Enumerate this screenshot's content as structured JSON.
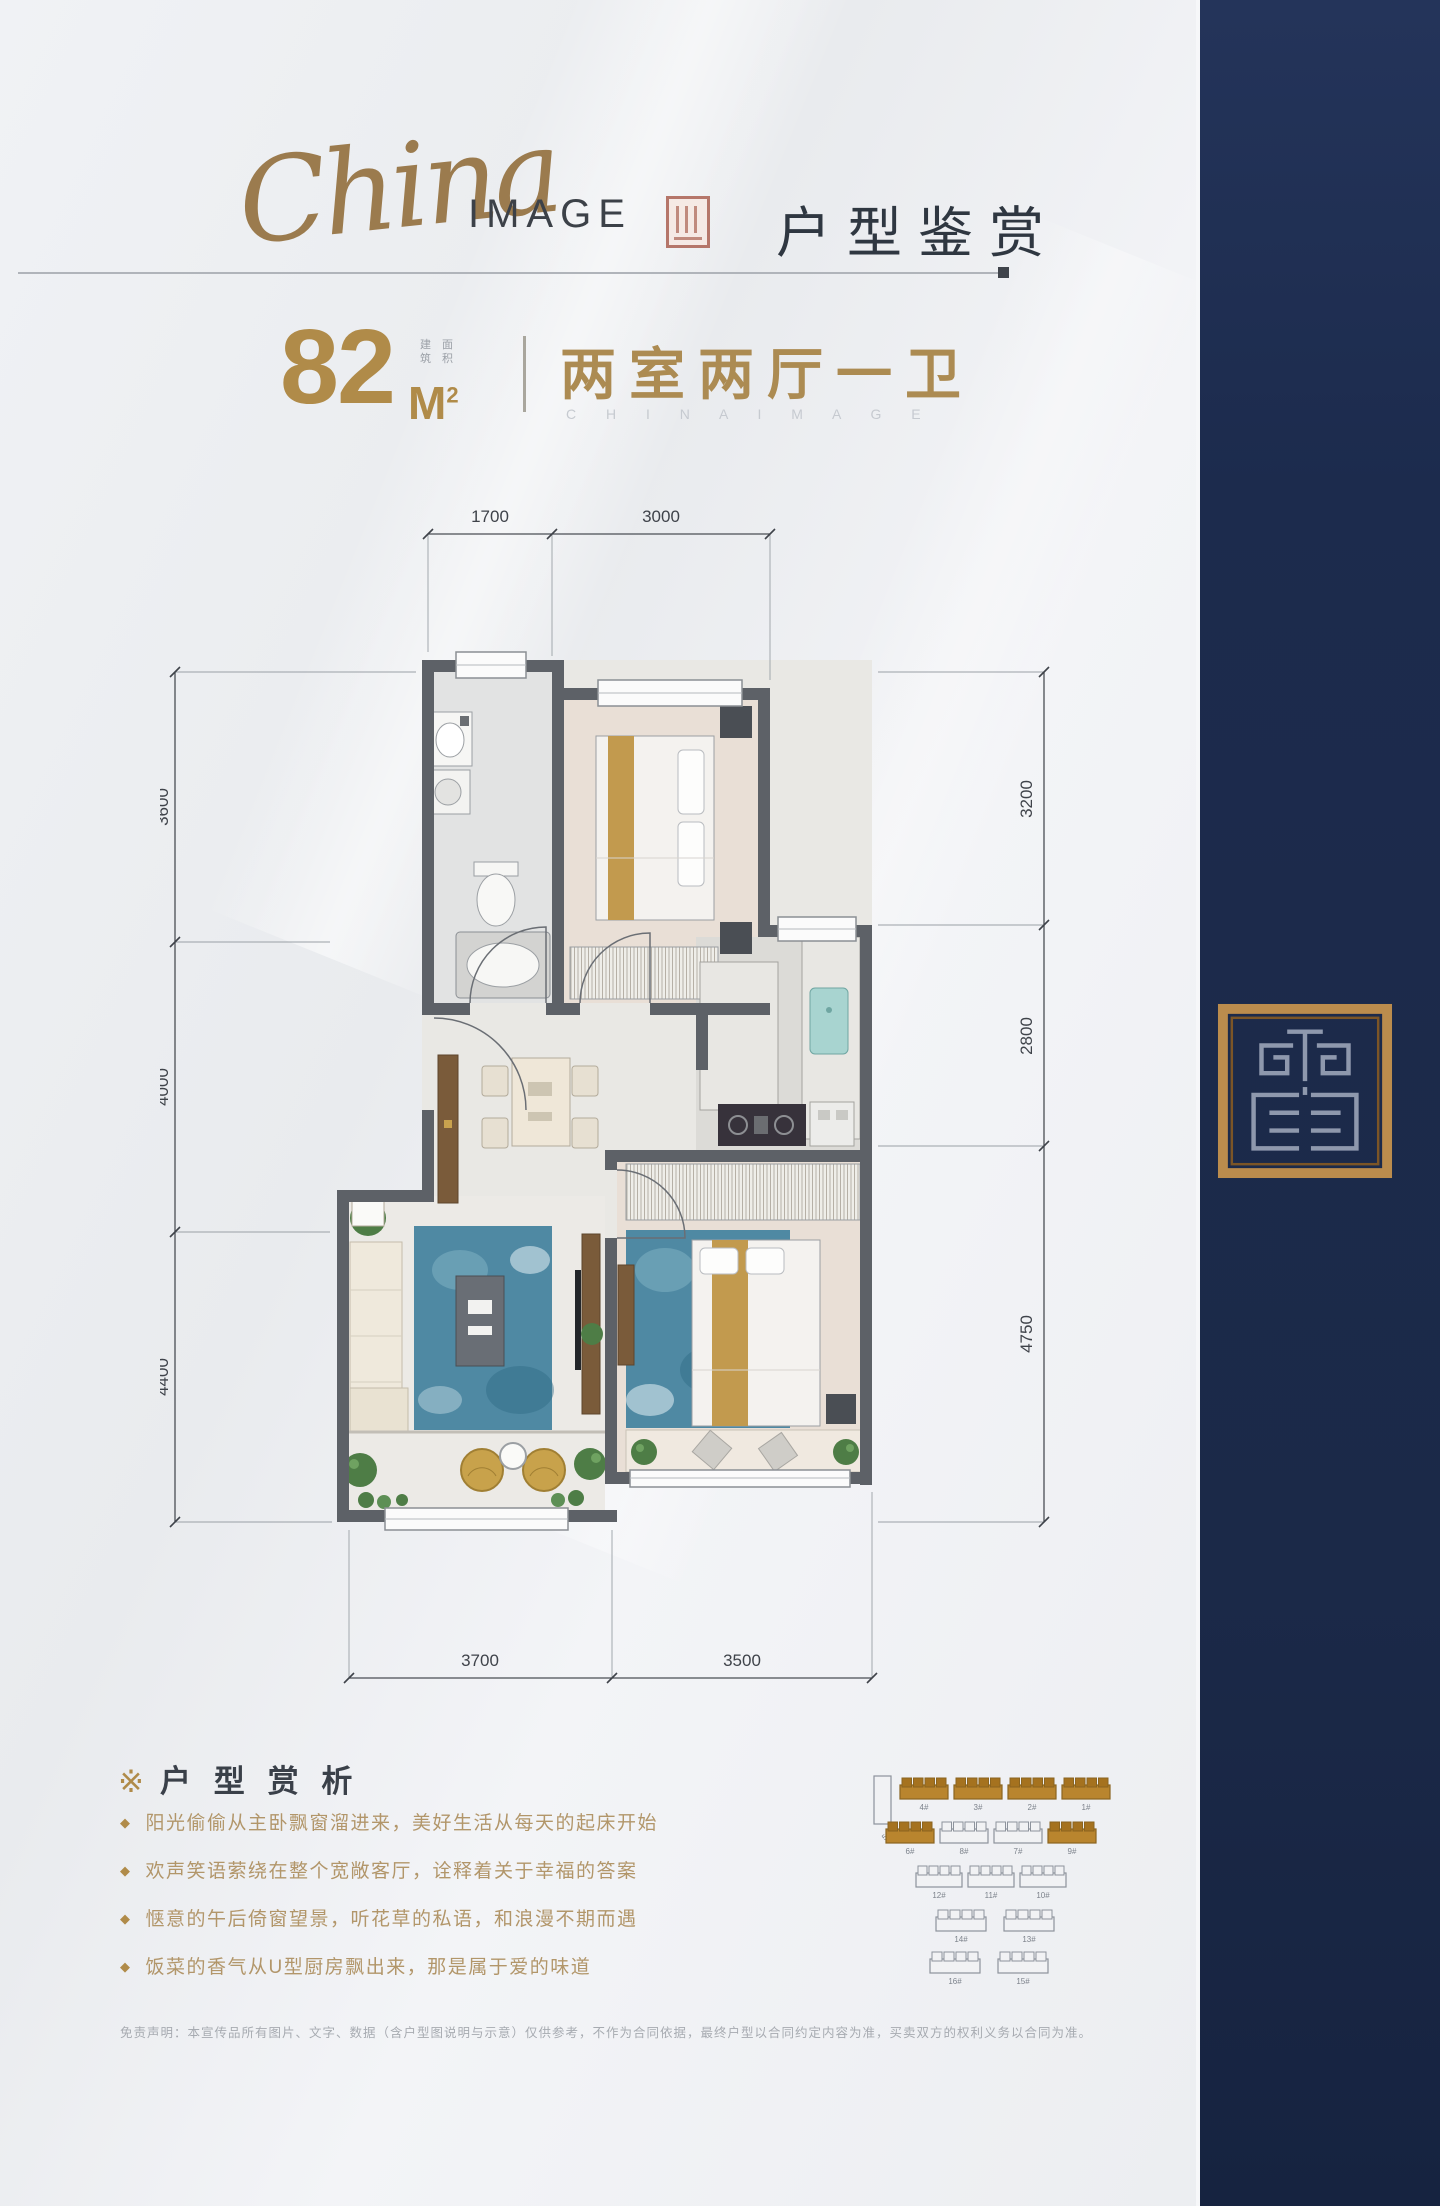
{
  "header": {
    "brand_script": "China",
    "brand_word": "IMAGE",
    "page_title": "户型鉴赏"
  },
  "unit": {
    "area": "82",
    "unit": "M",
    "sup": "2",
    "note_line1": "建 面",
    "note_line2": "筑 积",
    "layout": "两室两厅一卫",
    "latin": "C H I N A   I M A G E"
  },
  "floorplan": {
    "dimensions": {
      "top": [
        "1700",
        "3000"
      ],
      "left": [
        "3600",
        "4000",
        "4400"
      ],
      "right": [
        "3200",
        "2800",
        "4750"
      ],
      "bottom": [
        "3700",
        "3500"
      ]
    }
  },
  "analysis": {
    "marker": "※",
    "title": "户 型 赏 析",
    "bullet_marker": "◆",
    "bullets": [
      "阳光偷偷从主卧飘窗溜进来，美好生活从每天的起床开始",
      "欢声笑语萦绕在整个宽敞客厅，诠释着关于幸福的答案",
      "惬意的午后倚窗望景，听花草的私语，和浪漫不期而遇",
      "饭菜的香气从U型厨房飘出来，那是属于爱的味道"
    ]
  },
  "siteplan": {
    "tall": {
      "x": 2,
      "y": 4,
      "label": "5#"
    },
    "rows": [
      {
        "y": 6,
        "w": 48,
        "items": [
          {
            "x": 28,
            "label": "4#",
            "filled": true
          },
          {
            "x": 82,
            "label": "3#",
            "filled": true
          },
          {
            "x": 136,
            "label": "2#",
            "filled": true
          },
          {
            "x": 190,
            "label": "1#",
            "filled": true
          }
        ]
      },
      {
        "y": 50,
        "w": 48,
        "items": [
          {
            "x": 14,
            "label": "6#",
            "filled": true
          },
          {
            "x": 68,
            "label": "8#",
            "filled": false
          },
          {
            "x": 122,
            "label": "7#",
            "filled": false
          },
          {
            "x": 176,
            "label": "9#",
            "filled": true
          }
        ]
      },
      {
        "y": 94,
        "w": 46,
        "items": [
          {
            "x": 44,
            "label": "12#",
            "filled": false
          },
          {
            "x": 96,
            "label": "11#",
            "filled": false
          },
          {
            "x": 148,
            "label": "10#",
            "filled": false
          }
        ]
      },
      {
        "y": 138,
        "w": 50,
        "items": [
          {
            "x": 64,
            "label": "14#",
            "filled": false
          },
          {
            "x": 132,
            "label": "13#",
            "filled": false
          }
        ]
      },
      {
        "y": 180,
        "w": 50,
        "items": [
          {
            "x": 58,
            "label": "16#",
            "filled": false
          },
          {
            "x": 126,
            "label": "15#",
            "filled": false
          }
        ]
      }
    ]
  },
  "disclaimer": "免责声明：本宣传品所有图片、文字、数据（含户型图说明与示意）仅供参考，不作为合同依据，最终户型以合同约定内容为准，买卖双方的权利义务以合同为准。",
  "colors": {
    "gold": "#b08b49",
    "navy": "#1c2b4d",
    "seal_red": "#b5766a",
    "wall": "#5d6167",
    "rug_blue": "#4f89a3",
    "text_dark": "#333a44",
    "bullet_text": "#b2966a"
  }
}
